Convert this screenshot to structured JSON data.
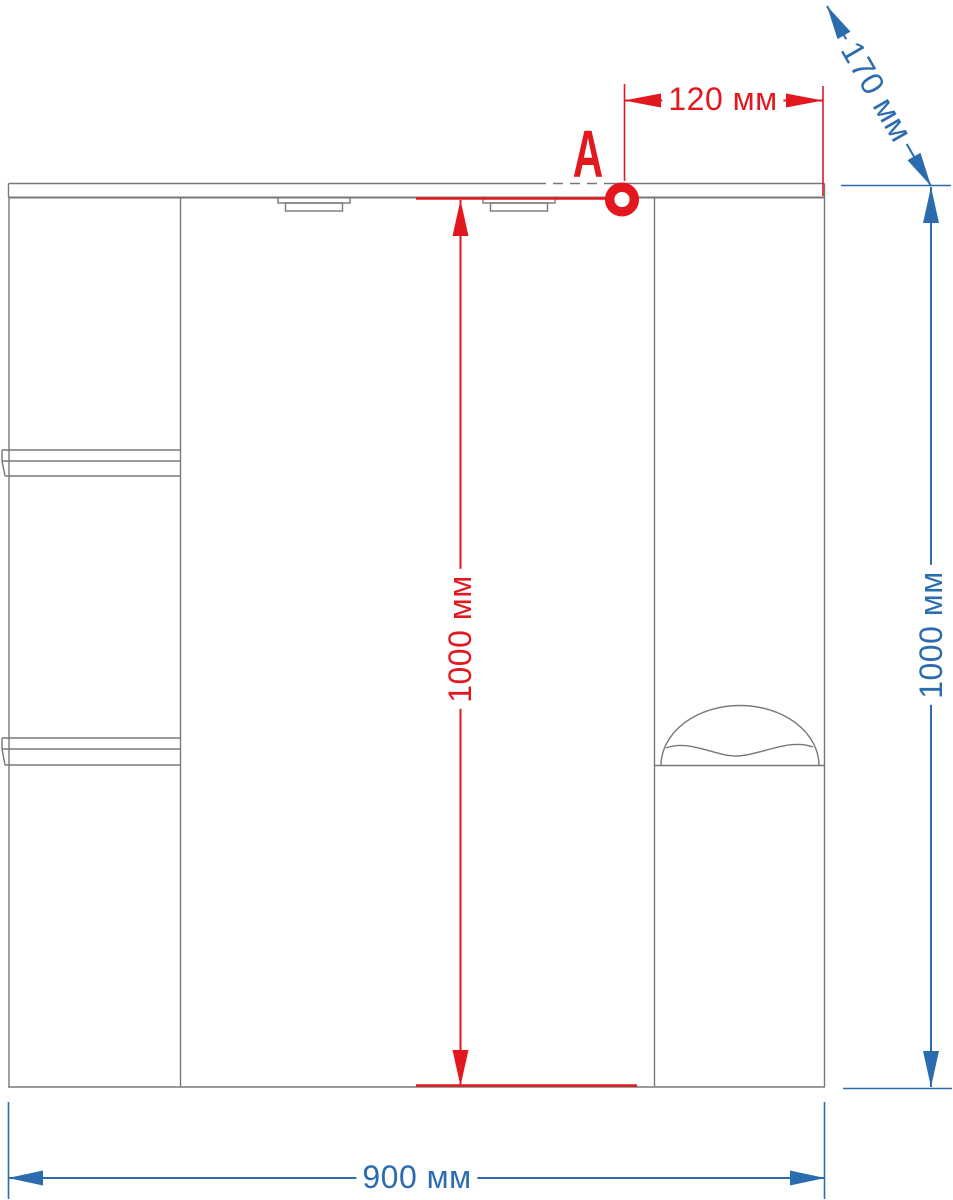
{
  "diagram": {
    "kind": "furniture dimension drawing",
    "subject": "mirror cabinet front view with open side shelves, two lamps and right door",
    "marker": {
      "label": "A"
    },
    "dims": {
      "d120": {
        "label": "120 мм",
        "value": 120,
        "unit": "мм",
        "color": "#e3181f",
        "orientation": "horizontal"
      },
      "d170": {
        "label": "170 мм",
        "value": 170,
        "unit": "мм",
        "color": "#2b6caf",
        "orientation": "diagonal"
      },
      "h_red": {
        "label": "1000 мм",
        "value": 1000,
        "unit": "мм",
        "color": "#e3181f",
        "orientation": "vertical"
      },
      "h_blue": {
        "label": "1000 мм",
        "value": 1000,
        "unit": "мм",
        "color": "#2b6caf",
        "orientation": "vertical"
      },
      "w900": {
        "label": "900 мм",
        "value": 900,
        "unit": "мм",
        "color": "#2b6caf",
        "orientation": "horizontal"
      }
    },
    "colors": {
      "dimension_red": "#e3181f",
      "dimension_blue": "#2b6caf",
      "outline_gray": "#787878",
      "background": "#ffffff"
    }
  }
}
